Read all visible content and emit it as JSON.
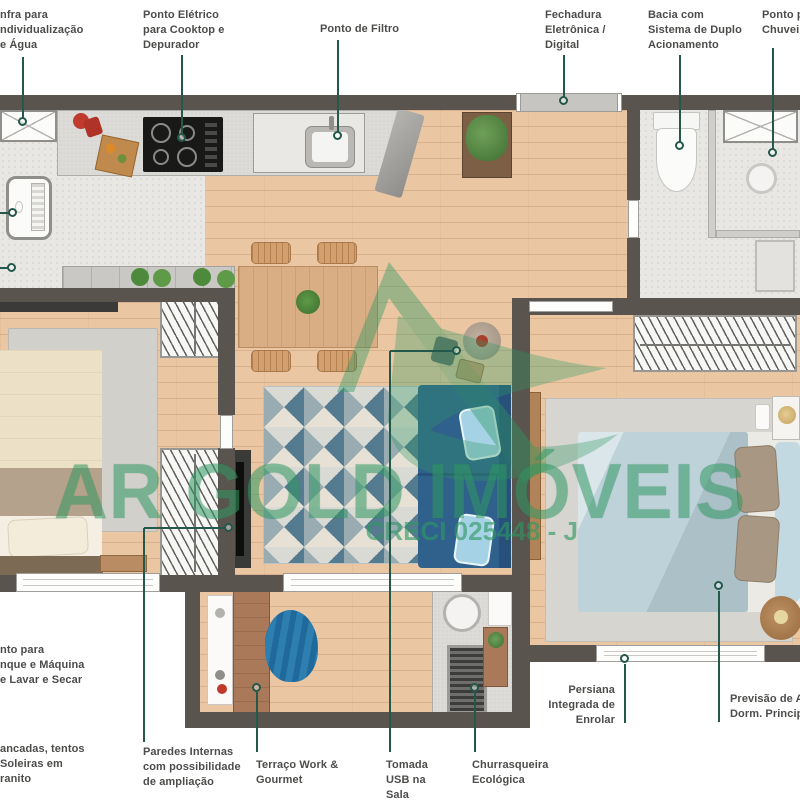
{
  "watermark": {
    "brand": "AR GOLD IMÓVEIS",
    "creci": "CRECI 025448 - J"
  },
  "callouts": {
    "infra_agua": {
      "lines": [
        "nfra para",
        "ndividualização",
        "e Água"
      ]
    },
    "ponto_eletrico": {
      "lines": [
        "Ponto  Elétrico",
        "para Cooktop e",
        "Depurador"
      ]
    },
    "ponto_filtro": {
      "lines": [
        "Ponto de Filtro"
      ]
    },
    "fechadura": {
      "lines": [
        "Fechadura",
        "Eletrônica /",
        "Digital"
      ]
    },
    "bacia": {
      "lines": [
        "Bacia com",
        "Sistema de Duplo",
        "Acionamento"
      ]
    },
    "chuveiro": {
      "lines": [
        "Ponto pa",
        "Chuveiro"
      ]
    },
    "tanque": {
      "lines": [
        "nto para",
        "nque e Máquina",
        "e Lavar e Secar"
      ]
    },
    "bancadas": {
      "lines": [
        "ancadas, tentos",
        "Soleiras em",
        "ranito"
      ]
    },
    "paredes": {
      "lines": [
        "Paredes Internas",
        "com possibilidade",
        "de ampliação"
      ]
    },
    "terraco": {
      "lines": [
        "Terraço Work &",
        "Gourmet"
      ]
    },
    "tomada": {
      "lines": [
        "Tomada",
        "USB na",
        "Sala"
      ]
    },
    "churrasqueira": {
      "lines": [
        "Churrasqueira",
        "Ecológica"
      ]
    },
    "persiana": {
      "lines": [
        "Persiana",
        "Integrada de",
        "Enrolar"
      ]
    },
    "ar_condicionado": {
      "lines": [
        "Previsão de Ar-",
        "Dorm. Principal"
      ]
    }
  },
  "colors": {
    "wall": "#59554e",
    "lead": "#23584a",
    "label": "#4c4c4a",
    "watermark": "#2f9862",
    "wood": "#eac7a2",
    "tile": "#e8e7e4"
  }
}
